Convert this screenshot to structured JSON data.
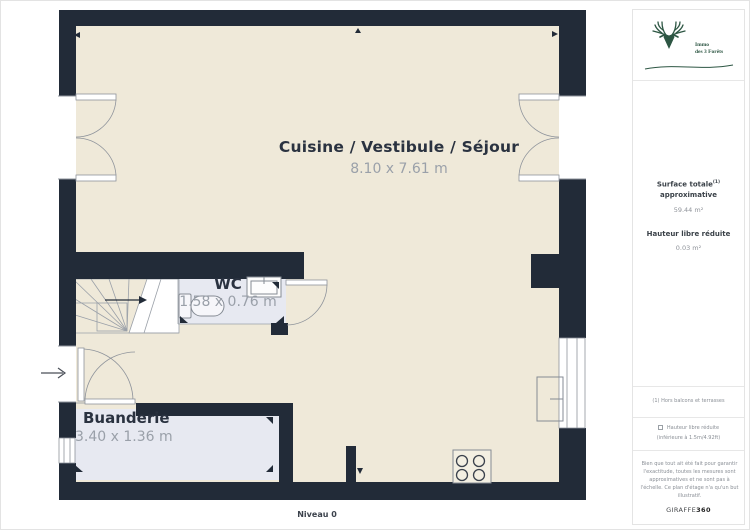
{
  "plan": {
    "level_label": "Niveau 0",
    "main_room": {
      "name": "Cuisine / Vestibule / Séjour",
      "dimensions": "8.10 x 7.61 m"
    },
    "wc": {
      "name": "WC",
      "dimensions": "1.58 x 0.76 m"
    },
    "laundry": {
      "name": "Buanderie",
      "dimensions": "3.40 x 1.36 m"
    }
  },
  "sidebar": {
    "brand": {
      "line1": "Immo",
      "line2": "des 3 Forêts"
    },
    "surface_total": {
      "label_line1": "Surface totale",
      "superscript": "(1)",
      "label_line2": "approximative",
      "value": "59.44 m²"
    },
    "reduced_height": {
      "label": "Hauteur libre réduite",
      "value": "0.03 m²"
    },
    "footnote": "(1) Hors balcons et terrasses",
    "legend": {
      "label": "Hauteur libre réduite",
      "detail": "(inférieure à 1.5m/4.92ft)"
    },
    "disclaimer": "Bien que tout ait été fait pour garantir l'exactitude, toutes les mesures sont approximatives et ne sont pas à l'échelle. Ce plan d'étage n'a qu'un but illustratif.",
    "watermark": {
      "normal": "GIRAFFE",
      "bold": "360"
    }
  },
  "colors": {
    "wall": "#222B38",
    "floor": "#EFE9D9",
    "highlight_room": "#E7E9F1",
    "label": "#2A3240",
    "dimension": "#9AA0A9",
    "brand_green": "#2D5643"
  }
}
